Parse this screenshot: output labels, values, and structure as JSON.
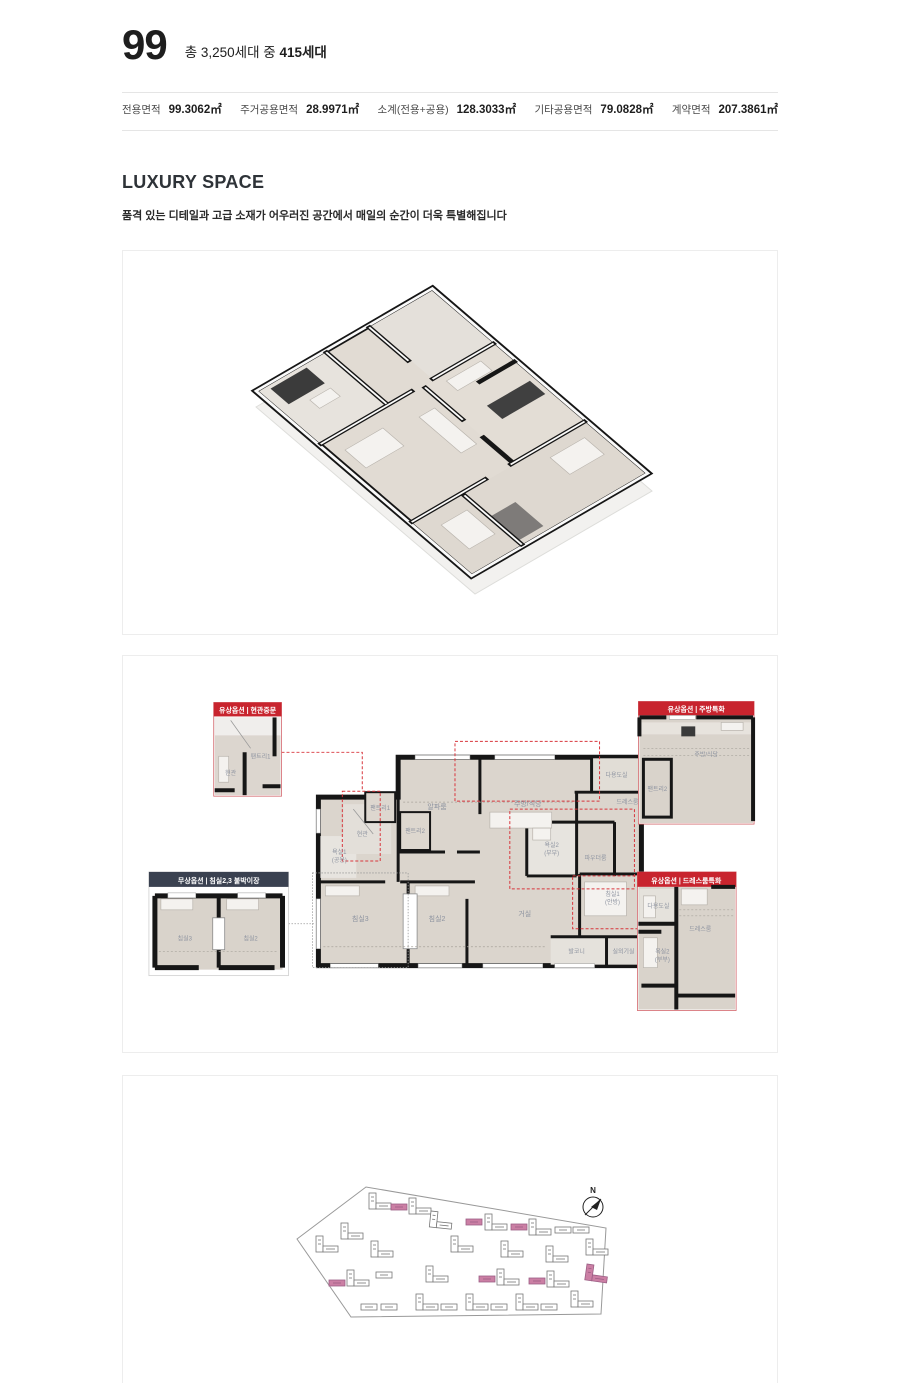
{
  "header": {
    "type_number": "99",
    "household_prefix": "총 3,250세대 중",
    "household_bold": "415세대"
  },
  "specs": {
    "items": [
      {
        "label": "전용면적",
        "value": "99.3062㎡"
      },
      {
        "label": "주거공용면적",
        "value": "28.9971㎡"
      },
      {
        "label": "소계(전용+공용)",
        "value": "128.3033㎡"
      },
      {
        "label": "기타공용면적",
        "value": "79.0828㎡"
      },
      {
        "label": "계약면적",
        "value": "207.3861㎡"
      }
    ]
  },
  "section": {
    "title": "LUXURY SPACE",
    "subtitle": "품격 있는 디테일과 고급 소재가 어우러진 공간에서 매일의 순간이 더욱 특별해집니다"
  },
  "plan": {
    "rooms": {
      "alpha": "알파룸",
      "kitchen": "주방/식당",
      "utility": "다용도실",
      "dress": "드레스룸",
      "pantry1": "팬트리1",
      "pantry2": "팬트리2",
      "entry": "현관",
      "bath1": "욕실1",
      "bath1_sub": "(공용)",
      "bath2": "욕실2",
      "bath2_sub": "(부부)",
      "powder": "파우더룸",
      "bed3": "침실3",
      "bed2": "침실2",
      "living": "거실",
      "bed1": "침실1",
      "bed1_sub": "(안방)",
      "balcony": "발코니",
      "outdoor_unit": "실외기실"
    },
    "callouts": {
      "entrance_door": {
        "title": "유상옵션 | 현관중문"
      },
      "kitchen_upgrade": {
        "title": "유상옵션 | 주방특화"
      },
      "builtin_closet": {
        "title": "무상옵션 | 침실2,3 붙박이장"
      },
      "dressroom_upgrade": {
        "title": "유상옵션 | 드레스룸특화"
      }
    }
  },
  "siteplan": {
    "compass": "N"
  },
  "colors": {
    "accent_red": "#c8242e",
    "header_navy": "#3a4150",
    "floor_beige": "#dbd5cd",
    "wall_black": "#161616"
  }
}
